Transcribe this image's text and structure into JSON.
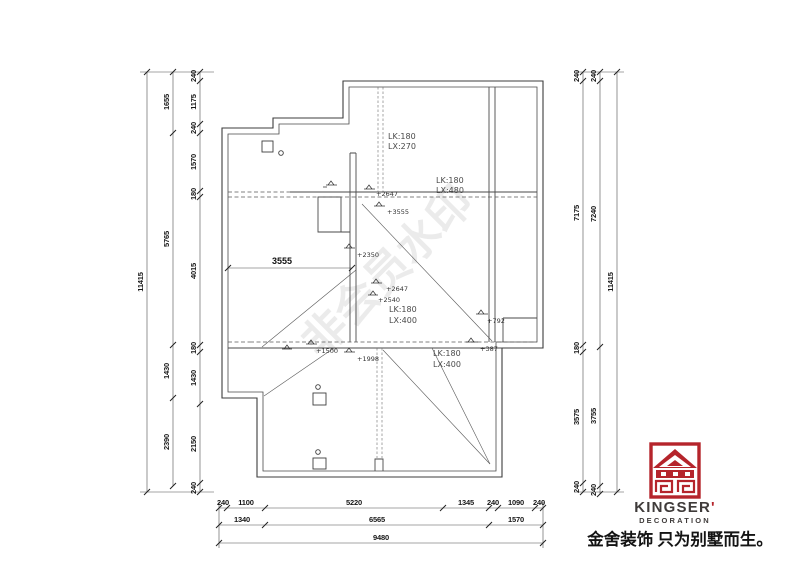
{
  "plan": {
    "interior_dim": "3555",
    "beam_labels": [
      {
        "line1": "LK:180",
        "line2": "LX:270"
      },
      {
        "line1": "LK:180",
        "line2": "LX:480"
      },
      {
        "line1": "LK:180",
        "line2": "LX:400"
      },
      {
        "line1": "LK:180",
        "line2": "LX:400"
      }
    ],
    "elevation_marks": [
      "+2647",
      "+3555",
      "+2350",
      "+2647",
      "+2540",
      "+792",
      "+387",
      "+1500",
      "+1998"
    ]
  },
  "dims": {
    "left_outer": [
      "11415"
    ],
    "left_middle": [
      "1655",
      "5765",
      "1430",
      "2390"
    ],
    "left_inner": [
      "240",
      "1175",
      "240",
      "1570",
      "180",
      "4015",
      "180",
      "1430",
      "2150",
      "240"
    ],
    "right_inner": [
      "240",
      "7175",
      "180",
      "3575",
      "240"
    ],
    "right_middle": [
      "240",
      "7240",
      "3755",
      "240"
    ],
    "right_outer": [
      "11415"
    ],
    "bottom_row1": [
      "240",
      "1100",
      "5220",
      "1345",
      "240",
      "1090",
      "240"
    ],
    "bottom_row2": [
      "1340",
      "6565",
      "1570"
    ],
    "bottom_row3": [
      "9480"
    ]
  },
  "watermark": "非会员水印",
  "logo": {
    "brand": "KINGSER",
    "brand_mark": "'",
    "subtitle": "DECORATION",
    "tagline": "金舍装饰 只为别墅而生。",
    "red": "#b5242b",
    "text_color": "#3f3b3a"
  }
}
